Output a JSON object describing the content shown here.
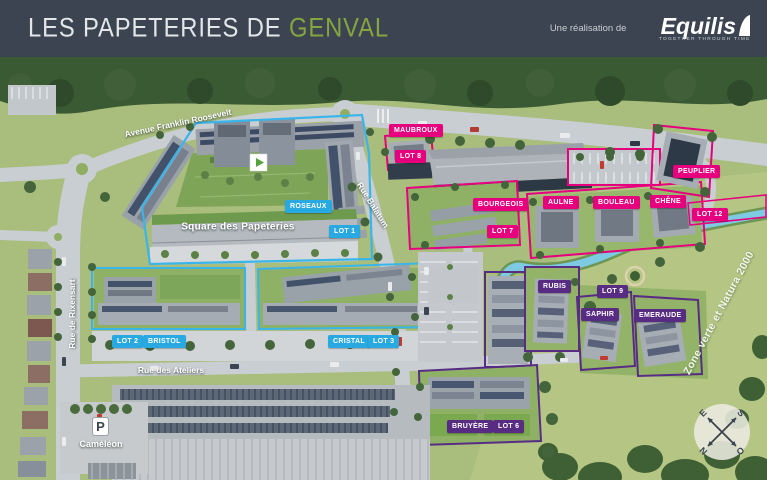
{
  "header": {
    "title_prefix": "LES PAPETERIES DE ",
    "title_highlight": "GENVAL",
    "credit": "Une réalisation de",
    "brand": "Equilis",
    "brand_tagline": "TOGETHER THROUGH TIME",
    "colors": {
      "bg": "#3b4450",
      "accent": "#85a53e"
    }
  },
  "map": {
    "streets": {
      "avenue": "Avenue Franklin Roosevelt",
      "balatum": "Rue Balatum",
      "rixensart": "Rue de Rixensart",
      "ateliers": "Rue des Ateliers"
    },
    "square": "Square des Papeteries",
    "zone": "Zone verte et Natura 2000",
    "parking_name": "Caméléon",
    "parking_icon": "P",
    "compass": {
      "n": "N",
      "s": "S",
      "e": "E",
      "o": "O"
    },
    "colors": {
      "blue": "#29a9e1",
      "pink": "#e6007e",
      "purple": "#582c83"
    },
    "lots": [
      {
        "name": "MAUBROUX",
        "phase": "pink"
      },
      {
        "name": "LOT 8",
        "phase": "pink"
      },
      {
        "name": "ROSEAUX",
        "phase": "blue"
      },
      {
        "name": "LOT 1",
        "phase": "blue"
      },
      {
        "name": "BOURGEOIS",
        "phase": "pink"
      },
      {
        "name": "LOT 7",
        "phase": "pink"
      },
      {
        "name": "AULNE",
        "phase": "pink"
      },
      {
        "name": "BOULEAU",
        "phase": "pink"
      },
      {
        "name": "CHÊNE",
        "phase": "pink"
      },
      {
        "name": "PEUPLIER",
        "phase": "pink"
      },
      {
        "name": "LOT 12",
        "phase": "pink"
      },
      {
        "name": "RUBIS",
        "phase": "purple"
      },
      {
        "name": "LOT 9",
        "phase": "purple"
      },
      {
        "name": "SAPHIR",
        "phase": "purple"
      },
      {
        "name": "EMERAUDE",
        "phase": "purple"
      },
      {
        "name": "LOT 2",
        "phase": "blue"
      },
      {
        "name": "BRISTOL",
        "phase": "blue"
      },
      {
        "name": "CRISTAL",
        "phase": "blue"
      },
      {
        "name": "LOT 3",
        "phase": "blue"
      },
      {
        "name": "BRUYÈRE",
        "phase": "purple"
      },
      {
        "name": "LOT 6",
        "phase": "purple"
      }
    ]
  }
}
